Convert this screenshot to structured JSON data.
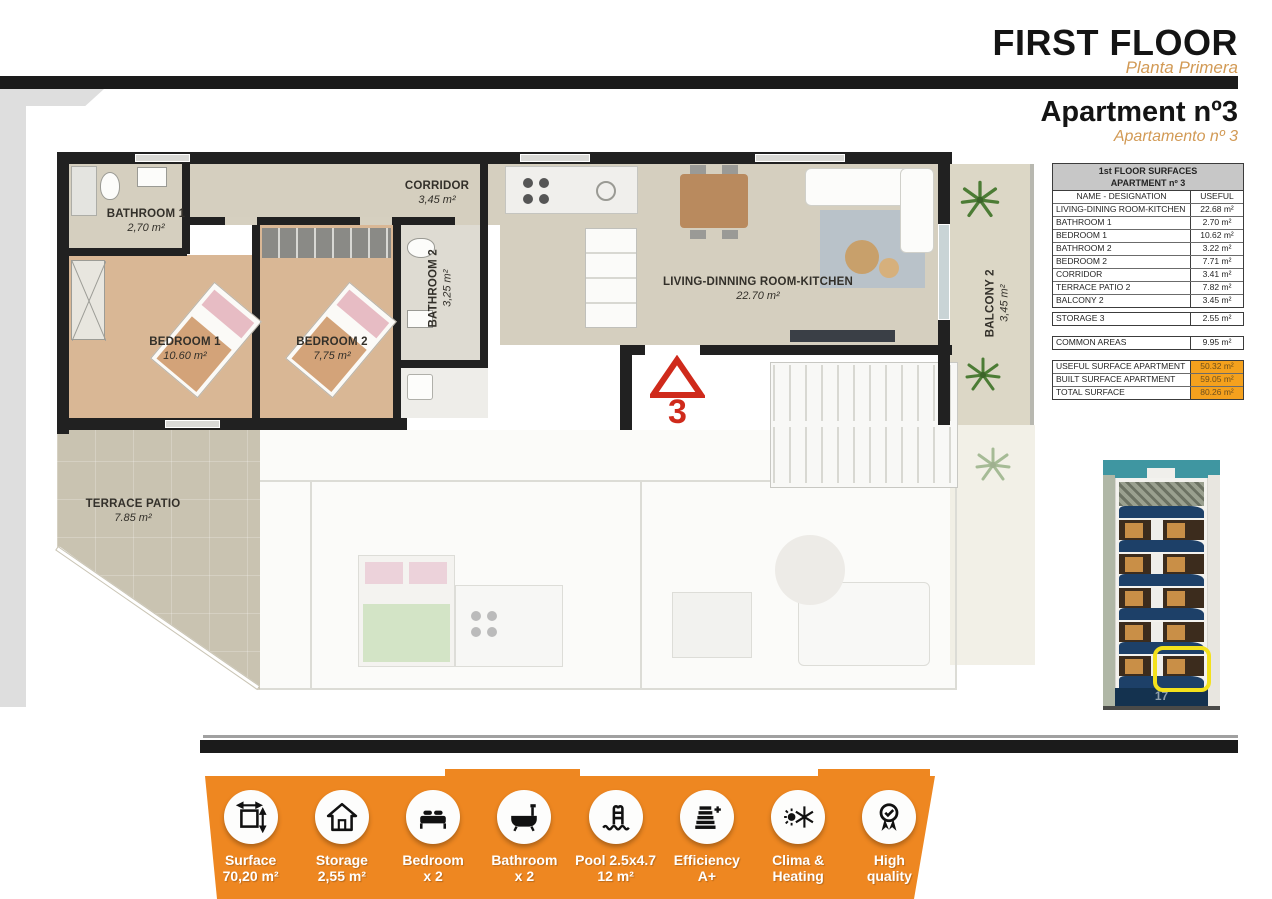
{
  "header": {
    "title": "FIRST FLOOR",
    "subtitle": "Planta Primera",
    "apartment_title": "Apartment nº3",
    "apartment_subtitle": "Apartamento nº 3"
  },
  "surfaces_table": {
    "title_line1": "1st FLOOR SURFACES",
    "title_line2": "APARTMENT nº 3",
    "col_name": "NAME - DESIGNATION",
    "col_useful": "USEFUL",
    "rows": [
      {
        "name": "LIVING-DINING ROOM-KITCHEN",
        "value": "22.68 m²"
      },
      {
        "name": "BATHROOM 1",
        "value": "2.70 m²"
      },
      {
        "name": "BEDROOM 1",
        "value": "10.62 m²"
      },
      {
        "name": "BATHROOM 2",
        "value": "3.22 m²"
      },
      {
        "name": "BEDROOM 2",
        "value": "7.71 m²"
      },
      {
        "name": "CORRIDOR",
        "value": "3.41 m²"
      },
      {
        "name": "TERRACE PATIO 2",
        "value": "7.82 m²"
      },
      {
        "name": "BALCONY 2",
        "value": "3.45 m²"
      }
    ],
    "storage_row": {
      "name": "STORAGE 3",
      "value": "2.55 m²"
    },
    "common_row": {
      "name": "COMMON AREAS",
      "value": "9.95 m²"
    },
    "totals": [
      {
        "name": "USEFUL SURFACE APARTMENT",
        "value": "50.32 m²"
      },
      {
        "name": "BUILT SURFACE APARTMENT",
        "value": "59.05 m²"
      },
      {
        "name": "TOTAL SURFACE",
        "value": "80.26 m²"
      }
    ]
  },
  "floorplan": {
    "entry_marker": "3",
    "rooms": {
      "bathroom1": {
        "label": "BATHROOM 1",
        "area": "2,70 m²"
      },
      "corridor": {
        "label": "CORRIDOR",
        "area": "3,45 m²"
      },
      "bathroom2": {
        "label": "BATHROOM 2",
        "area": "3,25 m²"
      },
      "living": {
        "label": "LIVING-DINNING ROOM-KITCHEN",
        "area": "22.70 m²"
      },
      "bedroom1": {
        "label": "BEDROOM 1",
        "area": "10.60 m²"
      },
      "bedroom2": {
        "label": "BEDROOM 2",
        "area": "7,75 m²"
      },
      "terrace": {
        "label": "TERRACE  PATIO",
        "area": "7.85 m²"
      },
      "balcony2": {
        "label": "BALCONY 2",
        "area": "3,45 m²"
      }
    }
  },
  "building": {
    "street_number": "17"
  },
  "features": {
    "items": [
      {
        "icon": "surface-dimensions-icon",
        "line1": "Surface",
        "line2": "70,20 m²"
      },
      {
        "icon": "storage-house-icon",
        "line1": "Storage",
        "line2": "2,55 m²"
      },
      {
        "icon": "bed-icon",
        "line1": "Bedroom",
        "line2": "x 2"
      },
      {
        "icon": "bathtub-icon",
        "line1": "Bathroom",
        "line2": "x 2"
      },
      {
        "icon": "pool-ladder-icon",
        "line1": "Pool 2.5x4.7",
        "line2": "12 m²"
      },
      {
        "icon": "energy-efficiency-icon",
        "line1": "Efficiency",
        "line2": "A+"
      },
      {
        "icon": "clima-heating-icon",
        "line1": "Clima &",
        "line2": "Heating"
      },
      {
        "icon": "quality-medal-icon",
        "line1": "High",
        "line2": "quality"
      }
    ]
  },
  "colors": {
    "accent_orange": "#ee8721",
    "accent_tan": "#d29a55",
    "table_highlight_orange": "#f5a11d",
    "marker_red": "#cf2a1b",
    "highlight_yellow": "#f3e11c",
    "balcony_navy": "#1d4068"
  }
}
